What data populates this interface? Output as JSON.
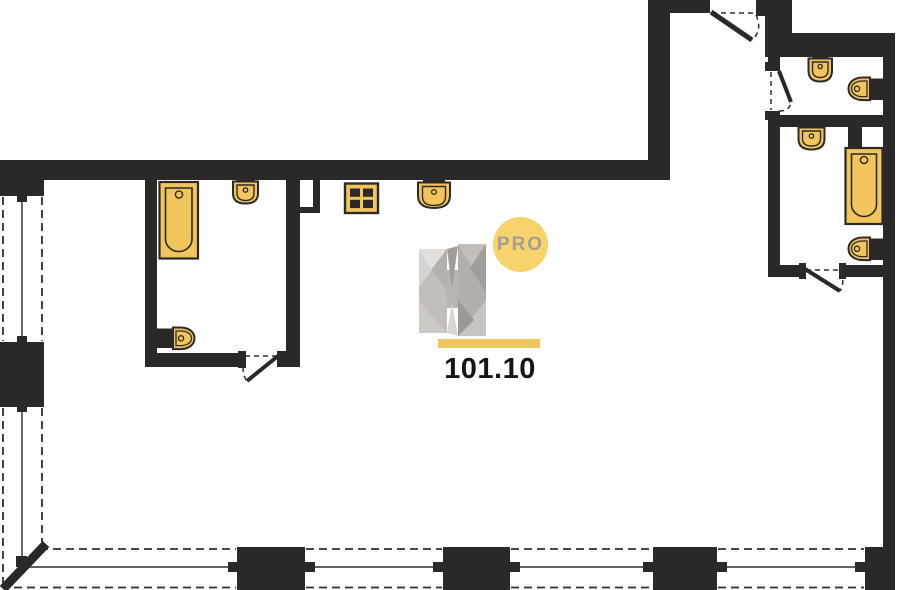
{
  "floorplan": {
    "logo": {
      "letter": "H",
      "badge_label": "PRO"
    },
    "area_label": "101.10",
    "fixture_icons": [
      "bathtub-icon",
      "sink-icon",
      "toilet-icon",
      "stove-grid-icon"
    ],
    "window_strips": [
      "left",
      "bottom"
    ],
    "door_count": 4
  },
  "colors": {
    "paper": "#ffffff",
    "wall": "#2a2927",
    "line": "#2f2e2c",
    "fixture": "#f2c55c",
    "outline": "#2b2a29",
    "badge": "#f8d26b",
    "bar": "#edc75e",
    "protext": "#a59e96",
    "areatext": "#151515",
    "h_light": "#e2dfdc",
    "h_mid": "#c3beba",
    "h_dark": "#a29d98"
  }
}
